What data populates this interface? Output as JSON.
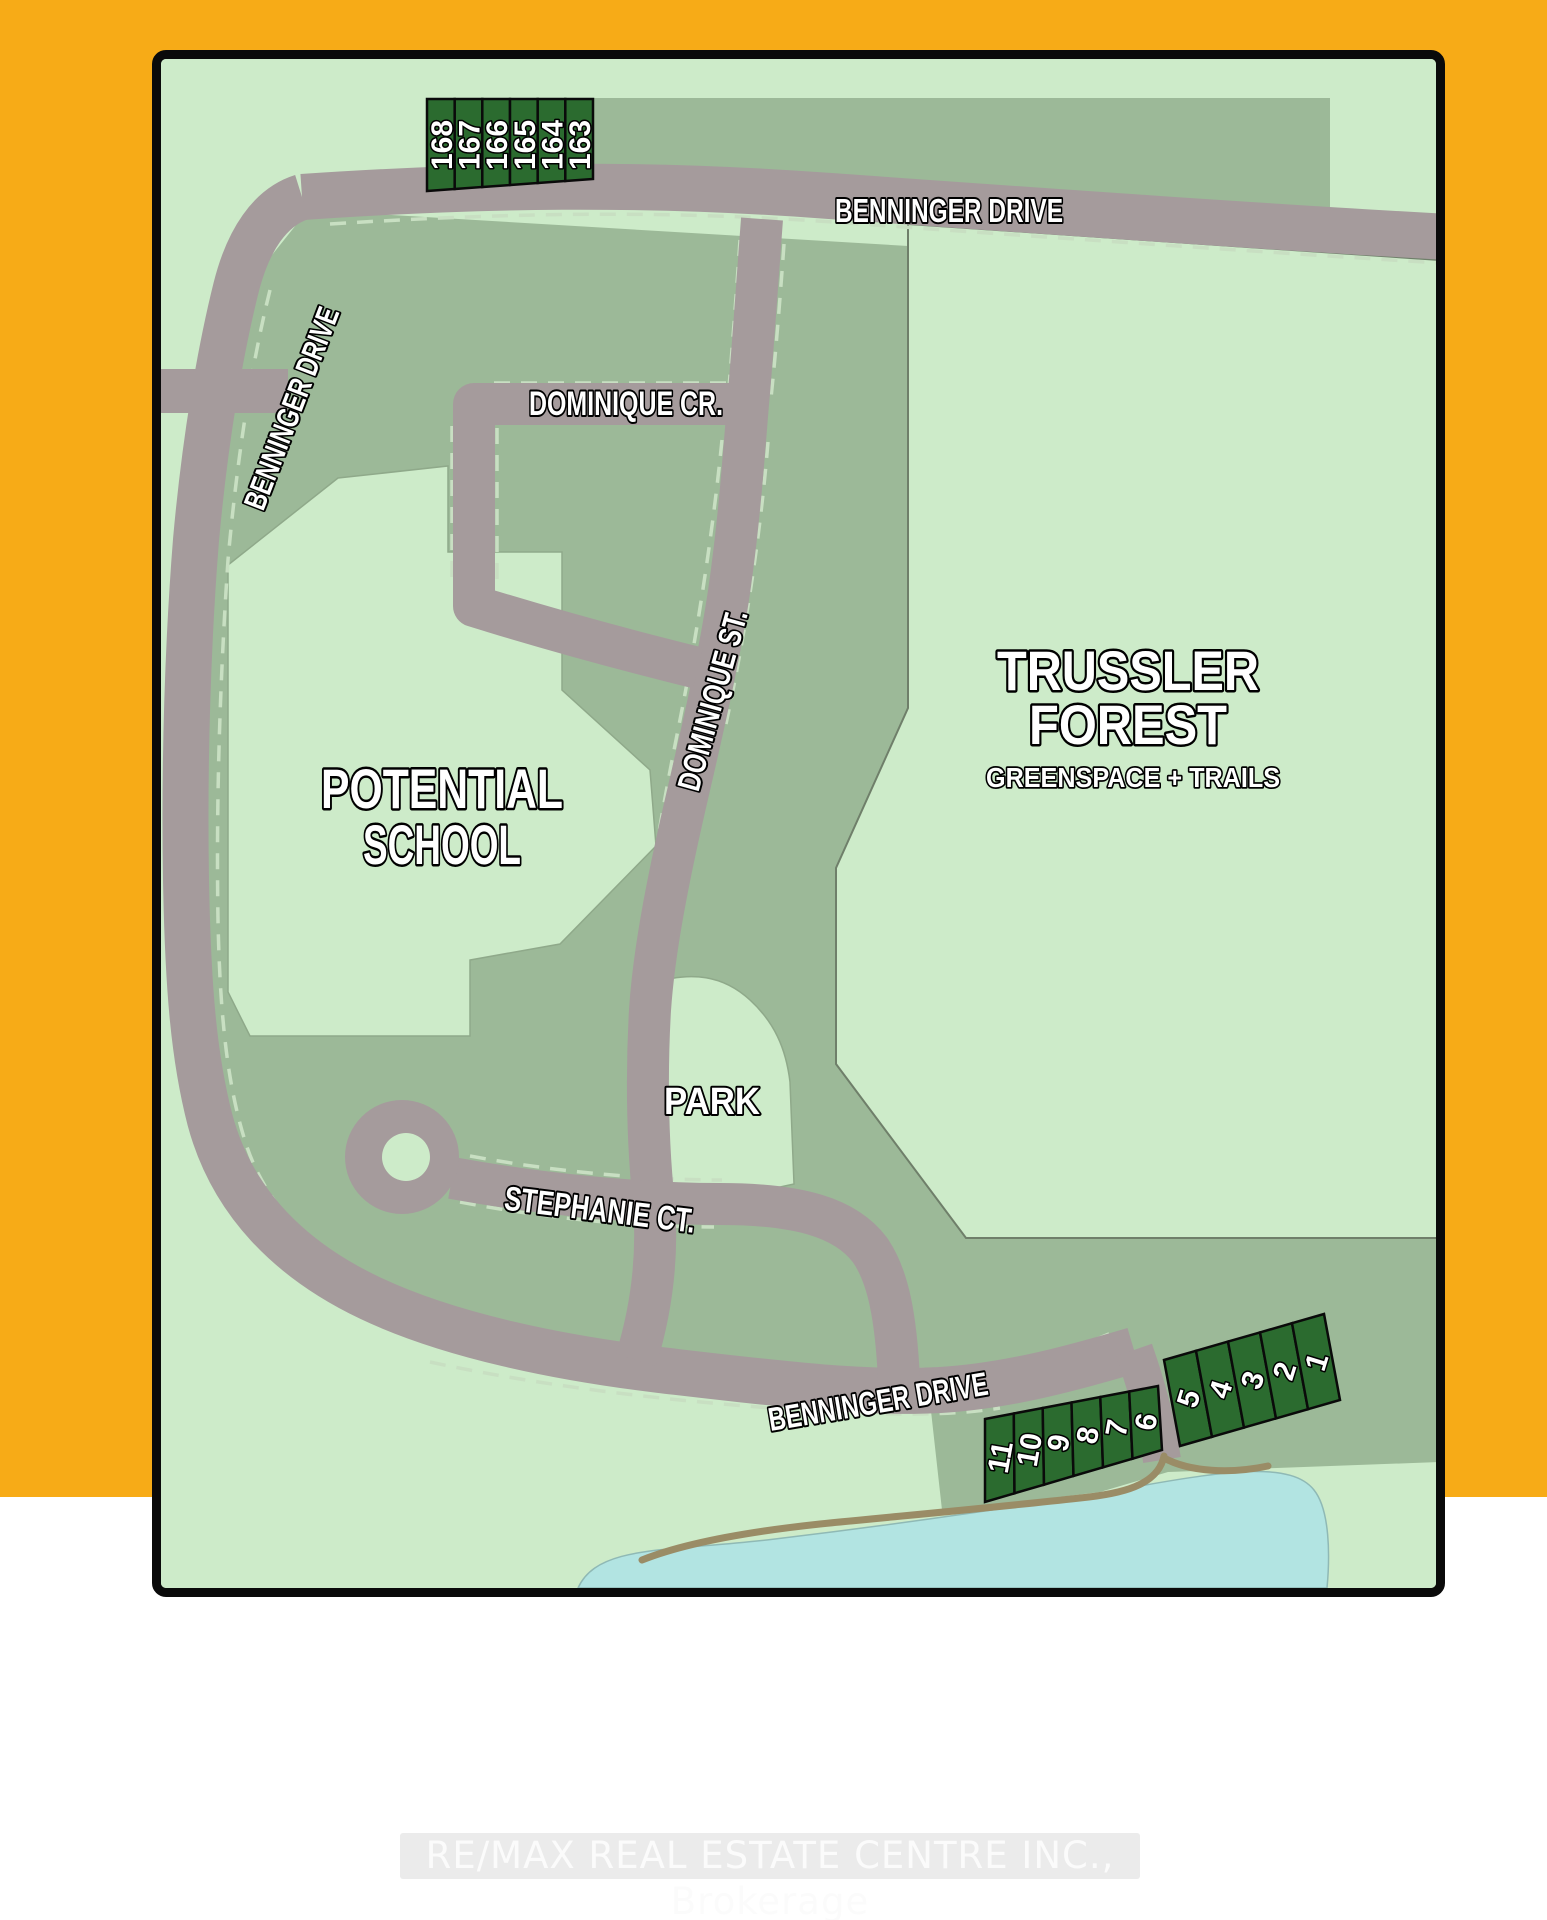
{
  "map": {
    "street_labels": {
      "benninger_top": "BENNINGER DRIVE",
      "benninger_west": "BENNINGER DRIVE",
      "benninger_south": "BENNINGER DRIVE",
      "dominique_crescent": "DOMINIQUE CR.",
      "dominique_street": "DOMINIQUE ST.",
      "stephanie_court": "STEPHANIE CT."
    },
    "area_labels": {
      "school_line1": "POTENTIAL",
      "school_line2": "SCHOOL",
      "forest_line1": "TRUSSLER",
      "forest_line2": "FOREST",
      "forest_subtitle": "GREENSPACE + TRAILS",
      "park": "PARK"
    },
    "lots": {
      "north_row": [
        "168",
        "167",
        "166",
        "165",
        "164",
        "163"
      ],
      "south_west_row": [
        "11",
        "10",
        "9",
        "8",
        "7",
        "6"
      ],
      "south_east_row": [
        "5",
        "4",
        "3",
        "2",
        "1"
      ]
    },
    "colors": {
      "frame_orange": "#F7AB17",
      "greenspace_green": "#CDEBC9",
      "residential_block_sage": "#9CB998",
      "road_gray": "#A59B9C",
      "lot_dark_green": "#2B6B2F",
      "pond_blue": "#B2E4E2",
      "trail_tan": "#9A8C66"
    }
  },
  "watermark": "RE/MAX REAL ESTATE CENTRE INC., Brokerage"
}
